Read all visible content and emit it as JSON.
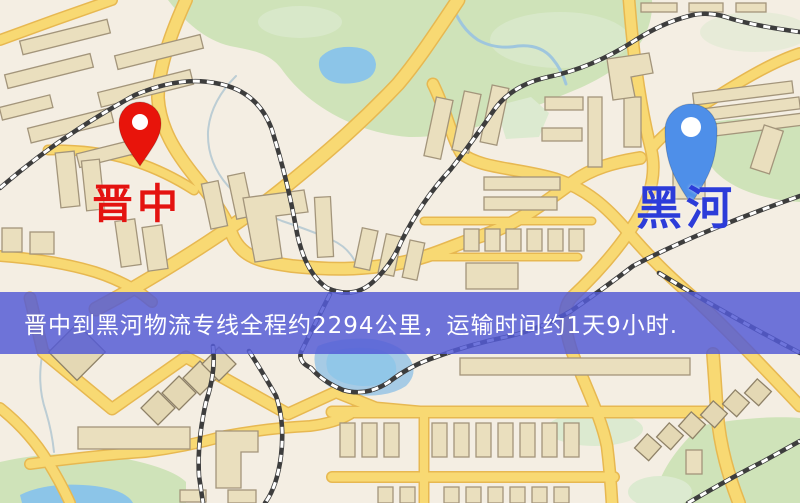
{
  "banner": {
    "text": "晋中到黑河物流专线全程约2294公里，运输时间约1天9小时.",
    "bg_style": "background:rgba(84,90,213,0.84)",
    "text_color": "#ffffff"
  },
  "markers": {
    "origin": {
      "name": "晋中",
      "pin_color": "#e8140b",
      "label_style": "color:#e41310"
    },
    "destination": {
      "name": "黑河",
      "pin_color": "#4e8fe9",
      "label_style": "color:#2c3cd9"
    }
  },
  "map_legend_colors": {
    "background": "#f4eee3",
    "road_fill": "#f8d973",
    "road_casing": "#e7b851",
    "building": "#eadfbe",
    "park": "#cfe3b9",
    "water": "#8cc5e8",
    "railway": "#3d3d3d",
    "banner_overlay": "#545ad5"
  }
}
